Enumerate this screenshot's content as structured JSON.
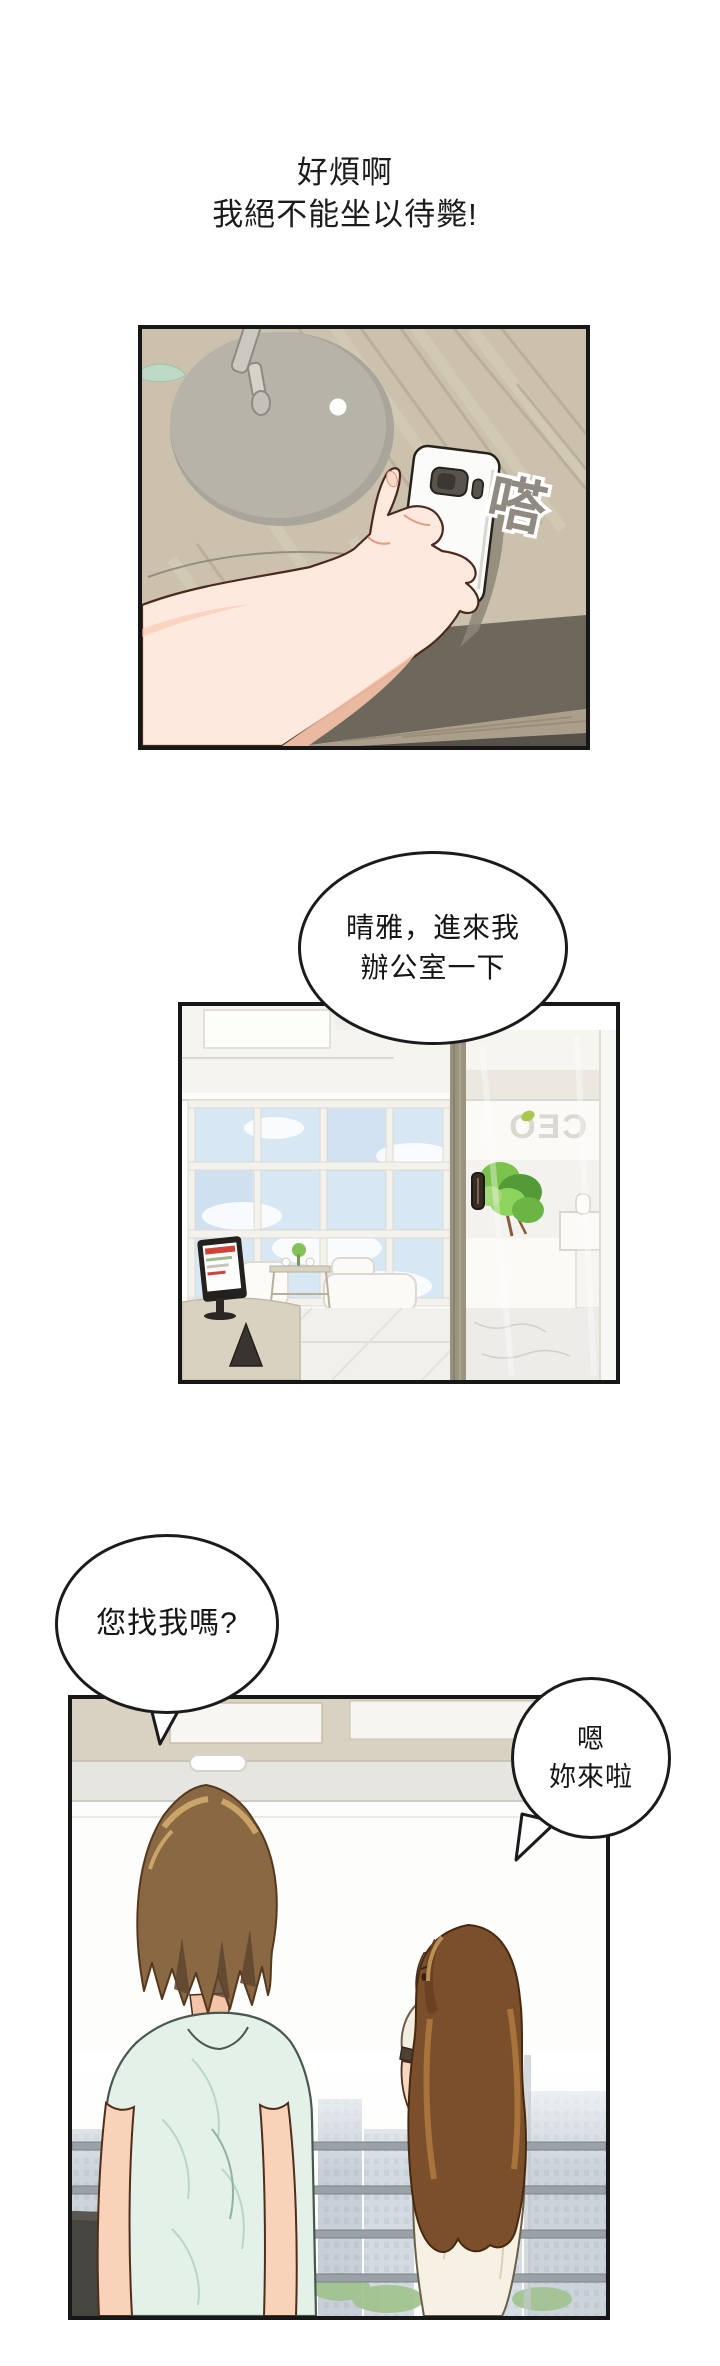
{
  "page": {
    "background": "#ffffff",
    "narration": {
      "line1": "好煩啊",
      "line2": "我絕不能坐以待斃!"
    },
    "panels": [
      {
        "id": "desk-phone",
        "description": "a hand picks a smartphone up from a wooden desk, grey lamp base beside it",
        "sfx": "嗒"
      },
      {
        "id": "ceo-office",
        "description": "bright office: glass window wall with sky, sofa, monitor desk, glass door of CEO room with plant and reception desk",
        "door_sign": "CEO"
      },
      {
        "id": "window-talk",
        "description": "man in mint shirt and long-haired woman in cream dress stand by an office window over a city view"
      }
    ],
    "bubbles": [
      {
        "id": "boss-call",
        "lines": [
          "晴雅，進來我",
          "辦公室一下"
        ]
      },
      {
        "id": "qingya-ask",
        "lines": [
          "您找我嗎?"
        ]
      },
      {
        "id": "boss-reply",
        "lines": [
          "嗯",
          "妳來啦"
        ]
      }
    ],
    "colors": {
      "panel_border": "#171717",
      "wood_desk": "#cbc1ad",
      "sfx_grey": "#8f8b83",
      "sky_blue": "#d8e7f4",
      "plant_green": "#7cc34e",
      "ceo_sign_grey": "#dad9d2",
      "man_shirt_mint": "#e3f1e8",
      "man_hair_brown": "#8a6843",
      "woman_hair_brown": "#7c4f2c",
      "woman_dress_cream": "#f6f1e3",
      "skin_light": "#fde9dd",
      "skin_shadow": "#f7c2a9",
      "city_grey_blue": "#ccd4dc"
    }
  }
}
